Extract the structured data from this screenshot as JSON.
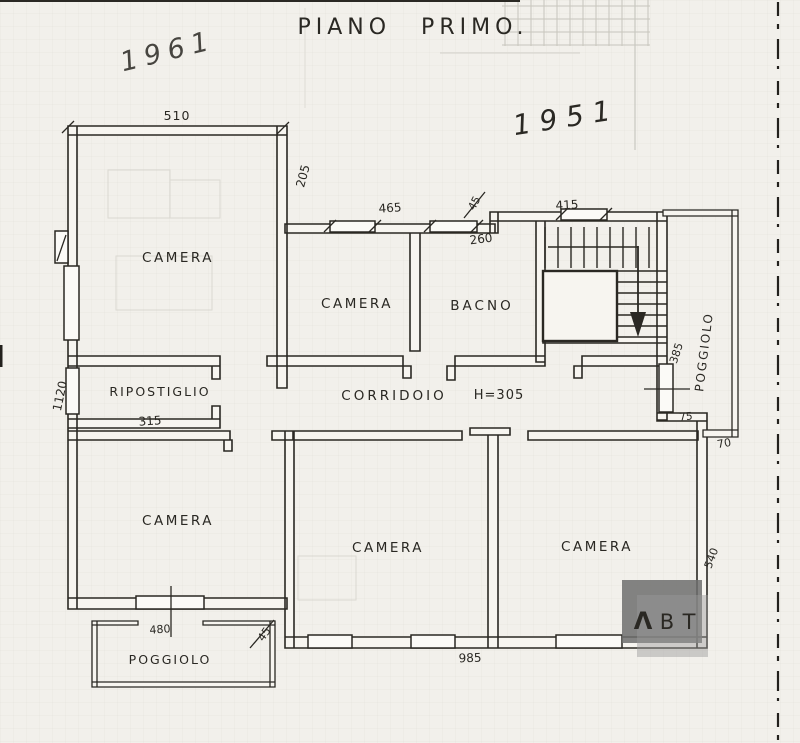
{
  "document": {
    "title": "PIANO PRIMO.",
    "handwriting": {
      "year_pencil": "1961",
      "year_ink": "1951"
    }
  },
  "rooms": {
    "camera_nw": "CAMERA",
    "camera_mid": "CAMERA",
    "bagno": "BACNO",
    "ripostiglio": "RIPOSTIGLIO",
    "corridoio": "CORRIDOIO",
    "camera_sw": "CAMERA",
    "camera_s": "CAMERA",
    "camera_se": "CAMERA",
    "poggiolo_sw": "POGGIOLO",
    "poggiolo_e": "POGGIOLO"
  },
  "dimensions": {
    "top_width": "510",
    "nw_right": "205",
    "mid_window": "465",
    "mid_small": "45",
    "stair_window": "415",
    "bagno_width": "260",
    "left_height": "1120",
    "ripostiglio_width": "315",
    "corridor_height": "H=305",
    "balcony_east_length": "385",
    "balcony_east_width": "75",
    "ledge_width": "70",
    "se_right": "540",
    "sw_window": "480",
    "sw_small": "45",
    "bottom_width": "985"
  },
  "logo": {
    "letter_a": "Λ",
    "letter_b": "B",
    "letter_t": "T"
  },
  "colors": {
    "ink": "#2a2823",
    "paper": "#f2f0eb",
    "pencil": "#a5a29a",
    "logo_red": "#e0363f",
    "logo_gray": "#6e6e6e"
  }
}
